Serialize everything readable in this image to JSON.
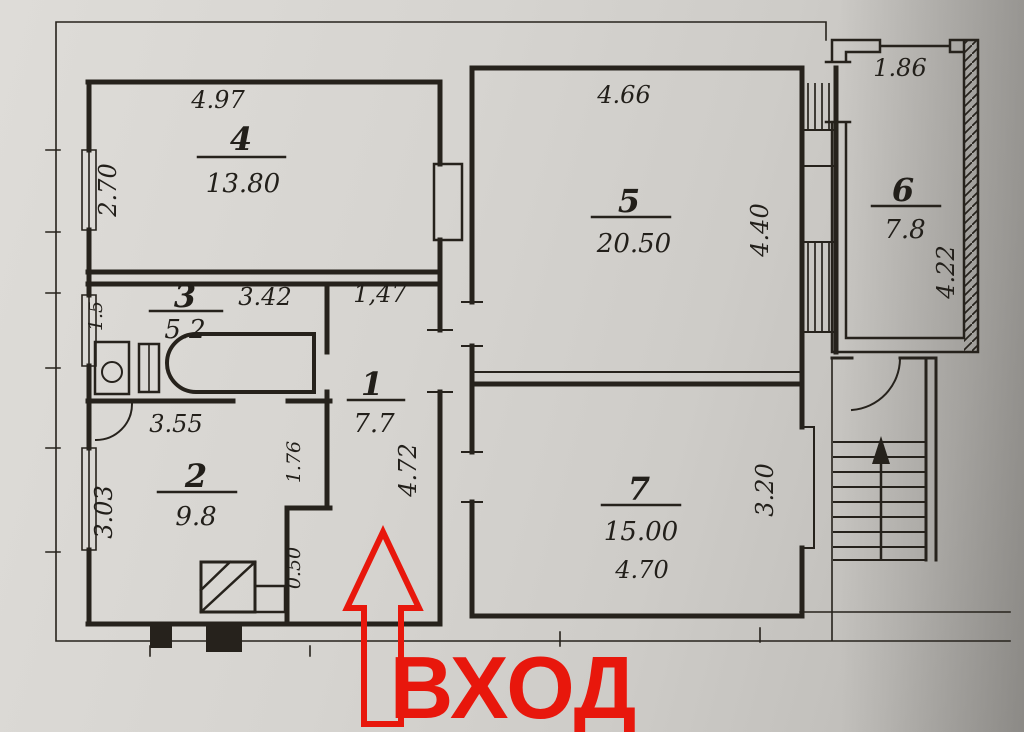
{
  "figure": {
    "kind": "scanned apartment floor plan",
    "colors": {
      "paper": "#d2d0cc",
      "ink": "#26221c",
      "accent_red": "#e8170c"
    }
  },
  "entrance": {
    "label": "ВХОД"
  },
  "rooms": {
    "r1": {
      "num": "1",
      "area": "7.7"
    },
    "r2": {
      "num": "2",
      "area": "9.8"
    },
    "r3": {
      "num": "3",
      "area": "5.2"
    },
    "r4": {
      "num": "4",
      "area": "13.80"
    },
    "r5": {
      "num": "5",
      "area": "20.50"
    },
    "r6": {
      "num": "6",
      "area": "7.8"
    },
    "r7": {
      "num": "7",
      "area": "15.00"
    }
  },
  "dims": {
    "d497": "4.97",
    "d270": "2.70",
    "d342": "3.42",
    "d15": "1.5",
    "d147": "1,47",
    "d355": "3.55",
    "d303": "3.03",
    "d176": "1.76",
    "d050": "0.50",
    "d472": "4.72",
    "d466": "4.66",
    "d440": "4.40",
    "d470": "4.70",
    "d320": "3.20",
    "d186": "1.86",
    "d422": "4.22"
  }
}
